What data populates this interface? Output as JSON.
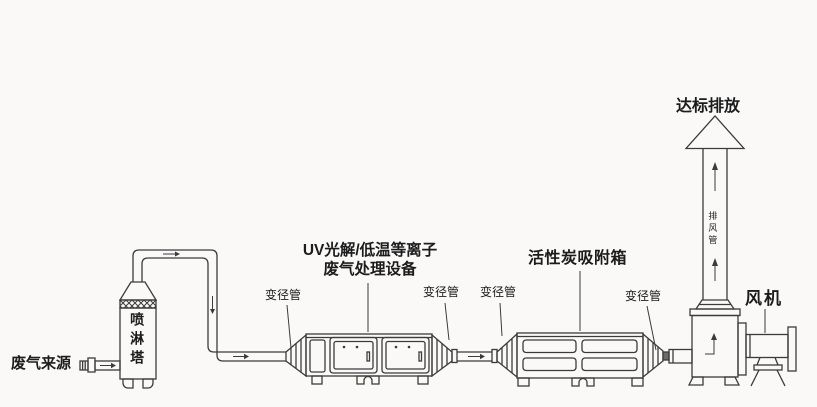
{
  "colors": {
    "line": "#3b3b3b",
    "text": "#1c1c1c",
    "background": "#faf9f8"
  },
  "components": {
    "waste_gas_source": {
      "label": "废气来源"
    },
    "spray_tower": {
      "label": "喷淋塔"
    },
    "uv_equipment": {
      "title_line1": "UV光解/低温等离子",
      "title_line2": "废气处理设备"
    },
    "carbon_box": {
      "title": "活性炭吸附箱"
    },
    "reducer_labels": [
      "变径管",
      "变径管",
      "变径管",
      "变径管"
    ],
    "fan": {
      "label": "风机"
    },
    "stack": {
      "pipe_label": "排风管",
      "emission_label": "达标排放"
    }
  }
}
